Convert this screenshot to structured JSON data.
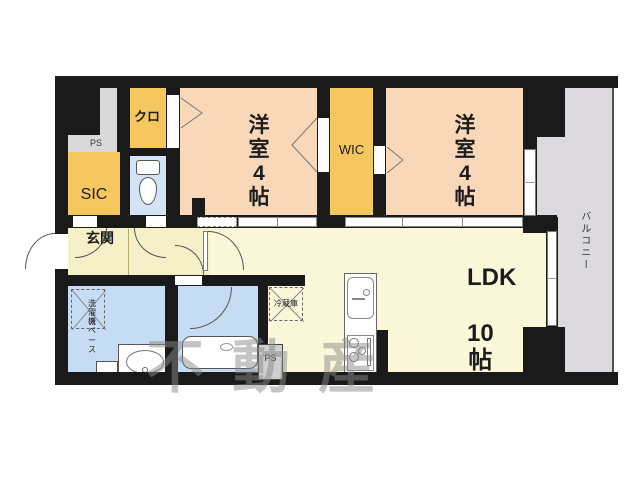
{
  "floorplan": {
    "rooms": {
      "bedroom_left": {
        "label": "洋室",
        "size": "4帖"
      },
      "bedroom_right": {
        "label": "洋室",
        "size": "4帖"
      },
      "ldk": {
        "label": "LDK",
        "size": "10帖"
      },
      "wic": {
        "label": "WIC"
      },
      "sic": {
        "label": "SIC"
      },
      "closet": {
        "label": "クロ"
      },
      "entrance": {
        "label": "玄関"
      },
      "balcony": {
        "label": "バルコニー"
      },
      "washer_space": {
        "label_line1": "洗濯機",
        "label_line2": "スペース"
      },
      "fridge": {
        "label": "冷蔵庫"
      },
      "ps_top": {
        "label": "PS"
      },
      "ps_bottom": {
        "label": "PS"
      }
    },
    "icons": [
      "toilet-icon",
      "bathtub-icon",
      "washbasin-icon",
      "kitchen-sink-icon",
      "stove-icon",
      "door-arc",
      "door-swing-triangle",
      "window"
    ],
    "watermark": "不動産",
    "colors": {
      "wall": "#1a1a1a",
      "bedroom": "#f8d8b8",
      "storage": "#f5c75f",
      "living": "#fbf8da",
      "hall": "#f6f0c8",
      "wet": "#c5dcf4",
      "toilet": "#d3e4f7",
      "balcony": "#dcdade",
      "ps_gray": "#d9d9d9"
    }
  }
}
